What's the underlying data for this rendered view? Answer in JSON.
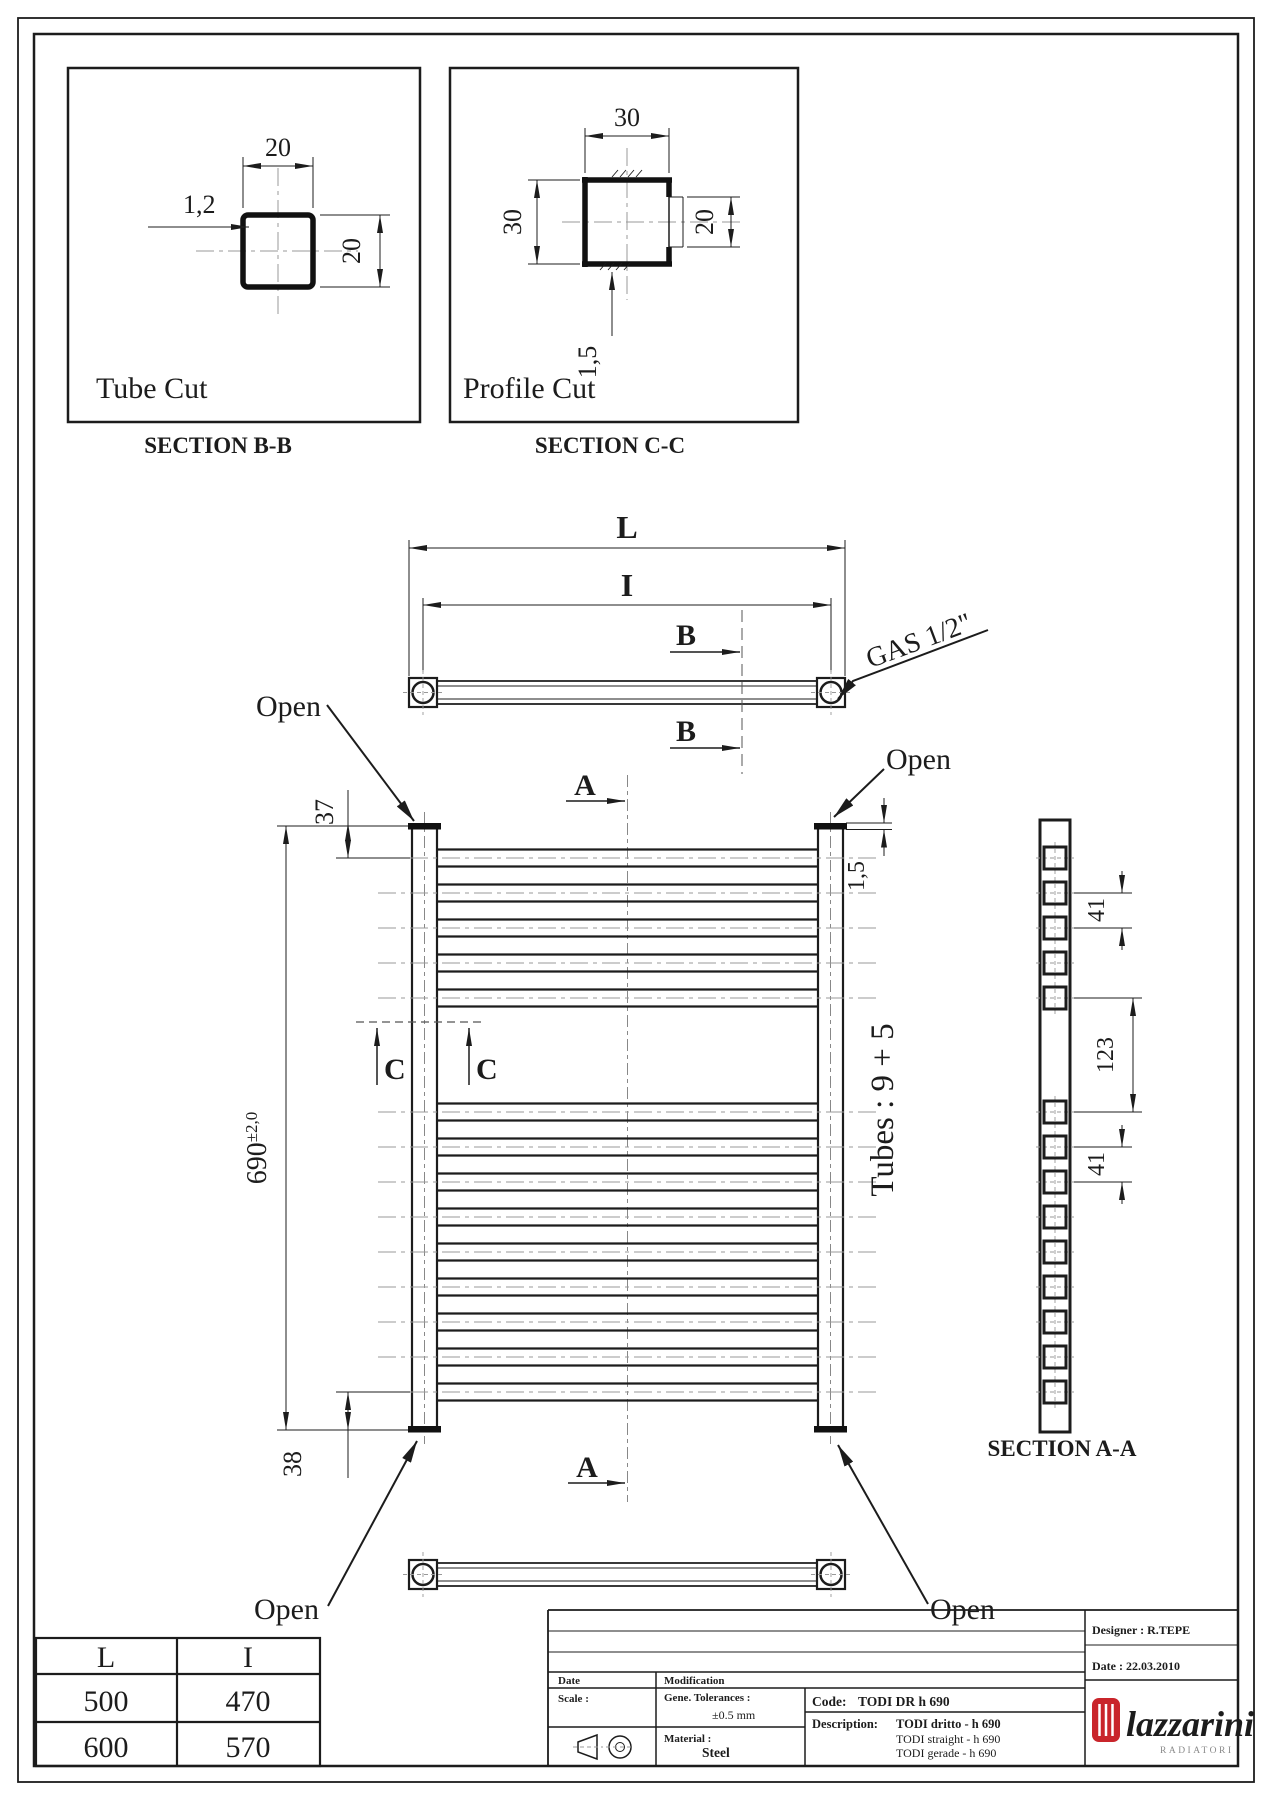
{
  "page": {
    "background": "#ffffff",
    "line_color": "#1c1c1c",
    "accent_red": "#c9252b"
  },
  "tube_cut": {
    "title": "Tube Cut",
    "section_label": "SECTION B-B",
    "dim_width": "20",
    "dim_height": "20",
    "dim_wall": "1,2"
  },
  "profile_cut": {
    "title": "Profile Cut",
    "section_label": "SECTION C-C",
    "dim_width": "30",
    "dim_height": "30",
    "dim_opening": "20",
    "dim_wall": "1,5"
  },
  "plan_view": {
    "dim_overall_label": "L",
    "dim_centers_label": "I",
    "section_b_label": "B",
    "gas_label": "GAS 1/2\""
  },
  "front_view": {
    "open_label": "Open",
    "section_a_label": "A",
    "section_c_label": "C",
    "dim_top_offset": "37",
    "dim_bottom_offset": "38",
    "dim_height": "690",
    "dim_height_tolerance": "±2,0",
    "dim_wall": "1,5",
    "tubes_label": "Tubes : 9 + 5"
  },
  "section_aa": {
    "label": "SECTION A-A",
    "dim_pitch_top": "41",
    "dim_gap": "123",
    "dim_pitch_bottom": "41"
  },
  "size_table": {
    "headers": [
      "L",
      "I"
    ],
    "rows": [
      [
        "500",
        "470"
      ],
      [
        "600",
        "570"
      ]
    ]
  },
  "title_block": {
    "designer": "Designer : R.TEPE",
    "date": "Date : 22.03.2010",
    "date_label": "Date",
    "modification_label": "Modification",
    "scale_label": "Scale :",
    "tolerance_label": "Gene. Tolerances :",
    "tolerance_value": "±0.5 mm",
    "material_label": "Material :",
    "material_value": "Steel",
    "code_label": "Code:",
    "code_value": "TODI DR h 690",
    "description_label": "Description:",
    "description_line1": "TODI dritto - h 690",
    "description_line2": "TODI straight - h 690",
    "description_line3": "TODI gerade - h 690",
    "brand": "lazzarini",
    "brand_sub": "RADIATORI"
  }
}
